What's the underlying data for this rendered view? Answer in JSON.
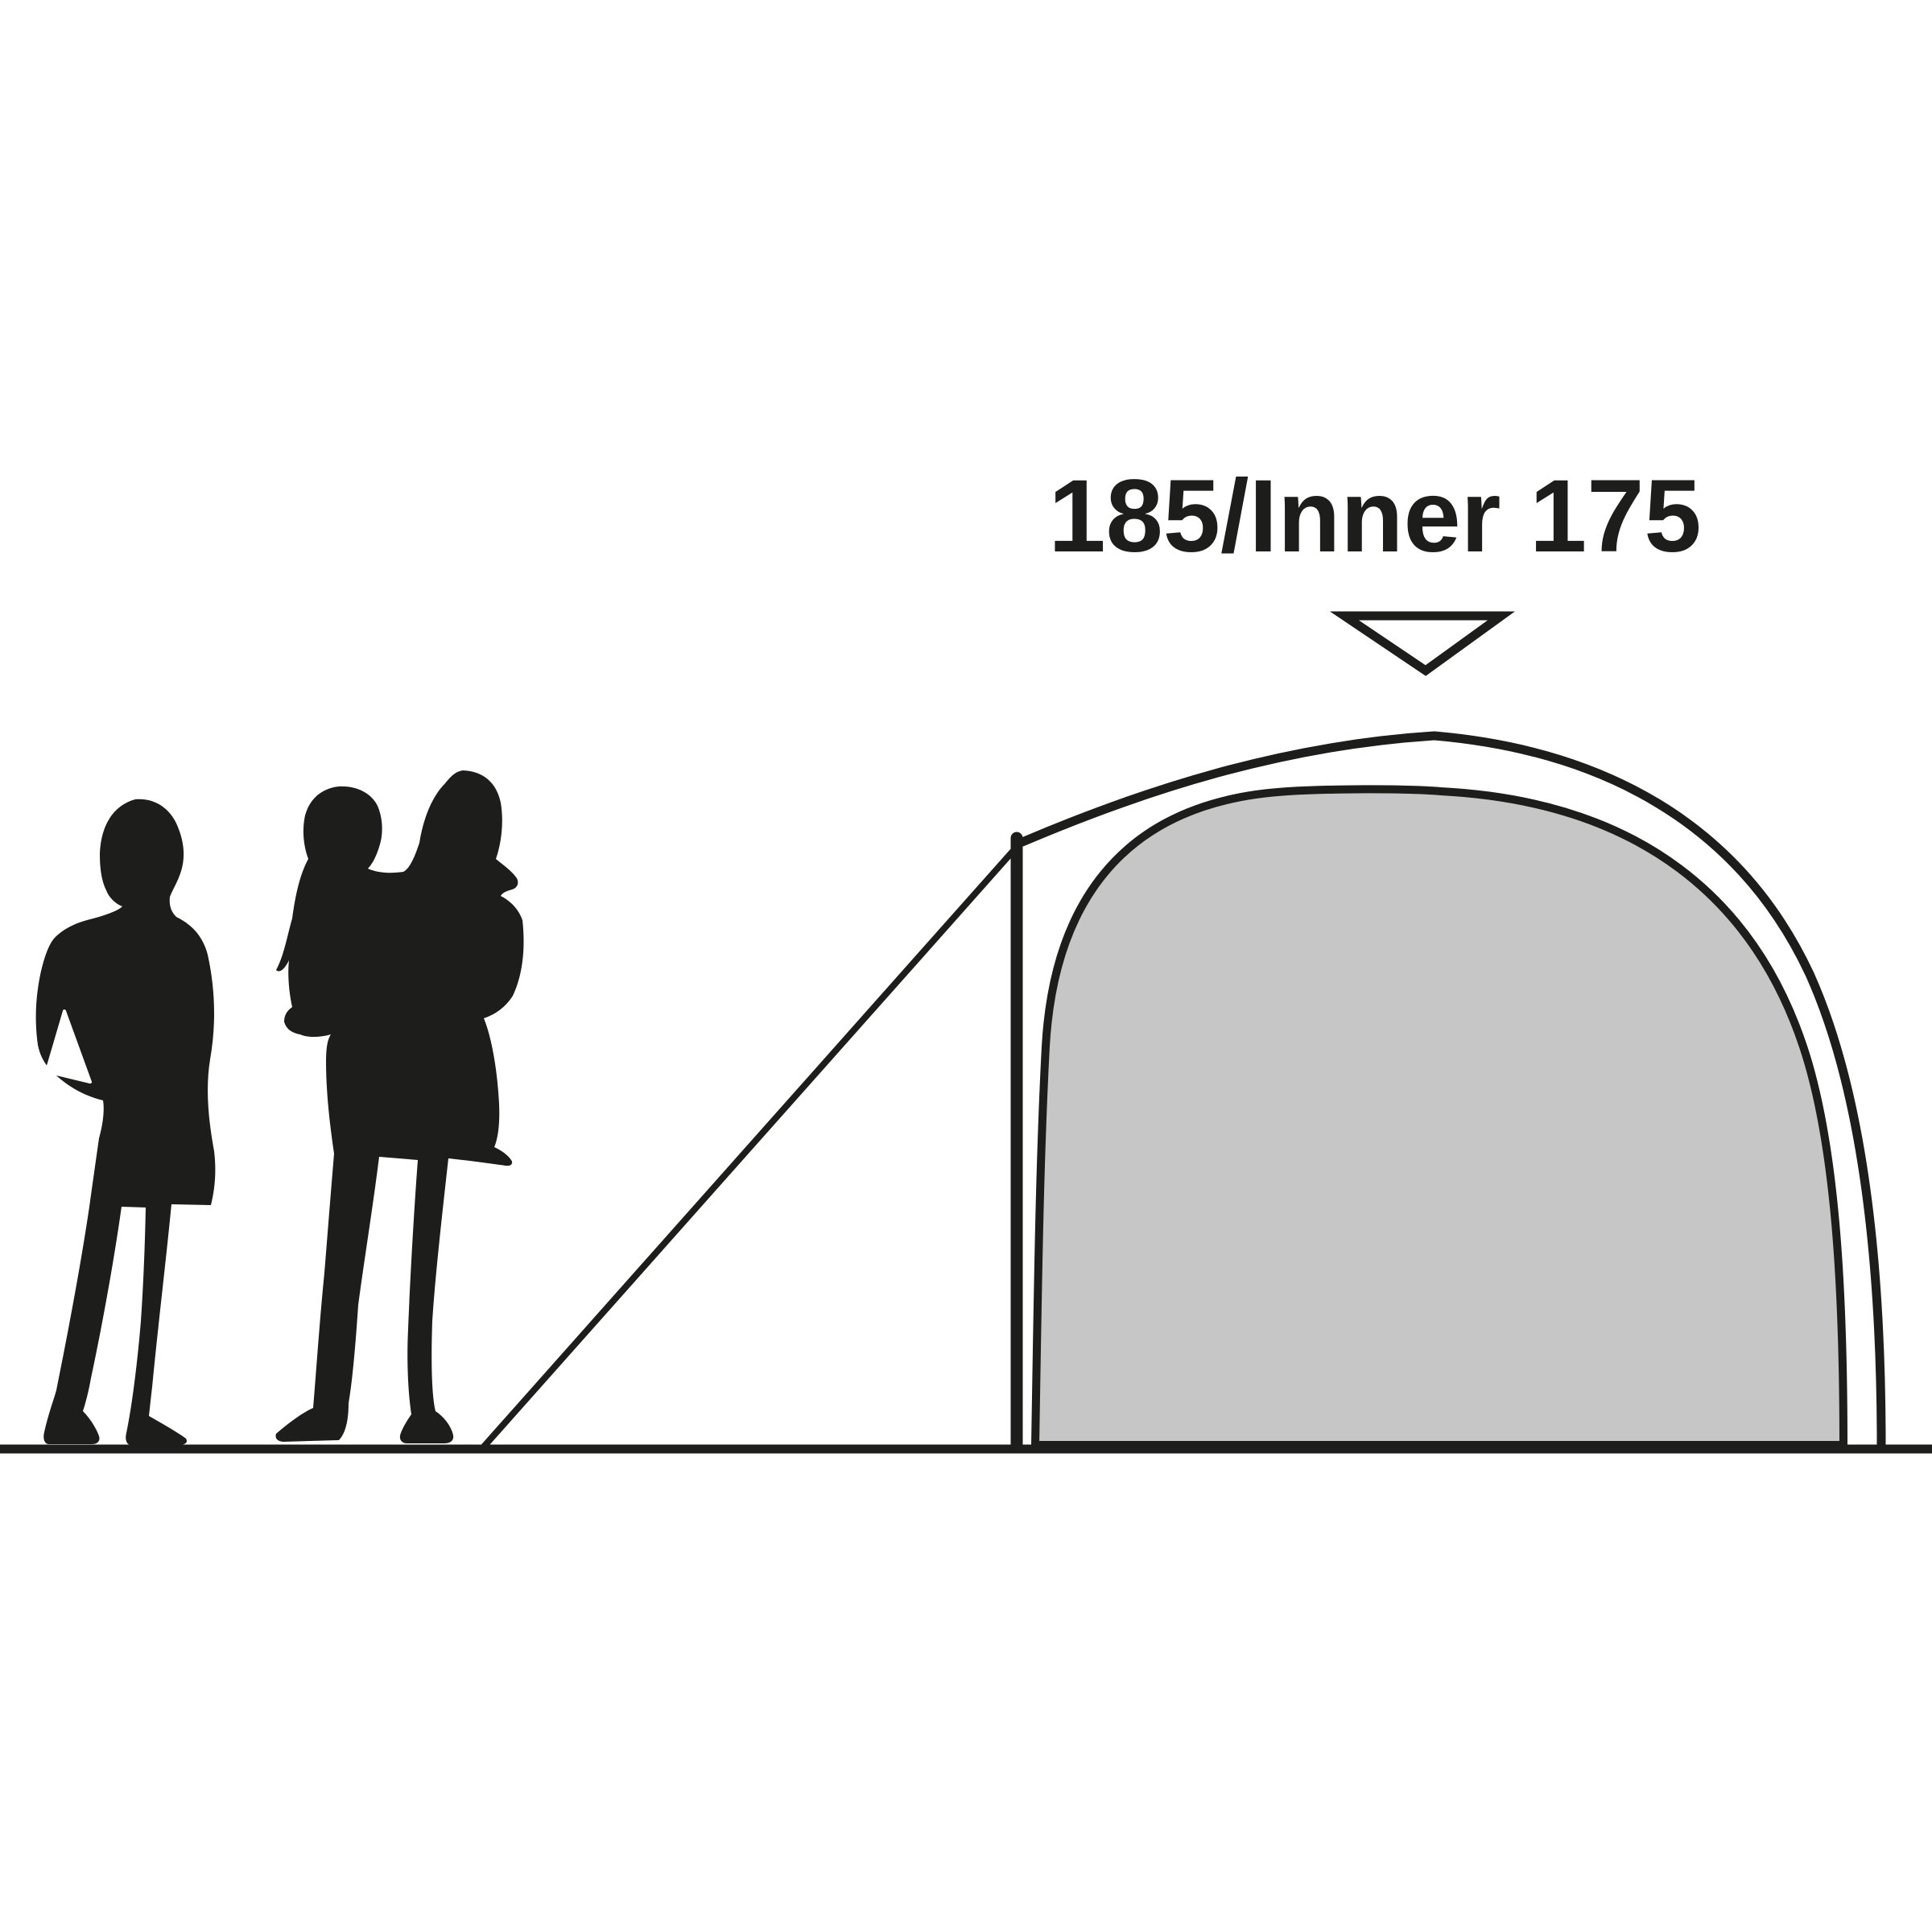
{
  "annotation": {
    "label": "185/Inner 175",
    "outer_height": "185",
    "inner_height": "175"
  },
  "icons": {
    "height_indicator": "triangle-down-arrow"
  },
  "colors": {
    "line": "#1d1d1b",
    "inner_tent_fill": "#c6c6c6",
    "background": "#ffffff"
  }
}
